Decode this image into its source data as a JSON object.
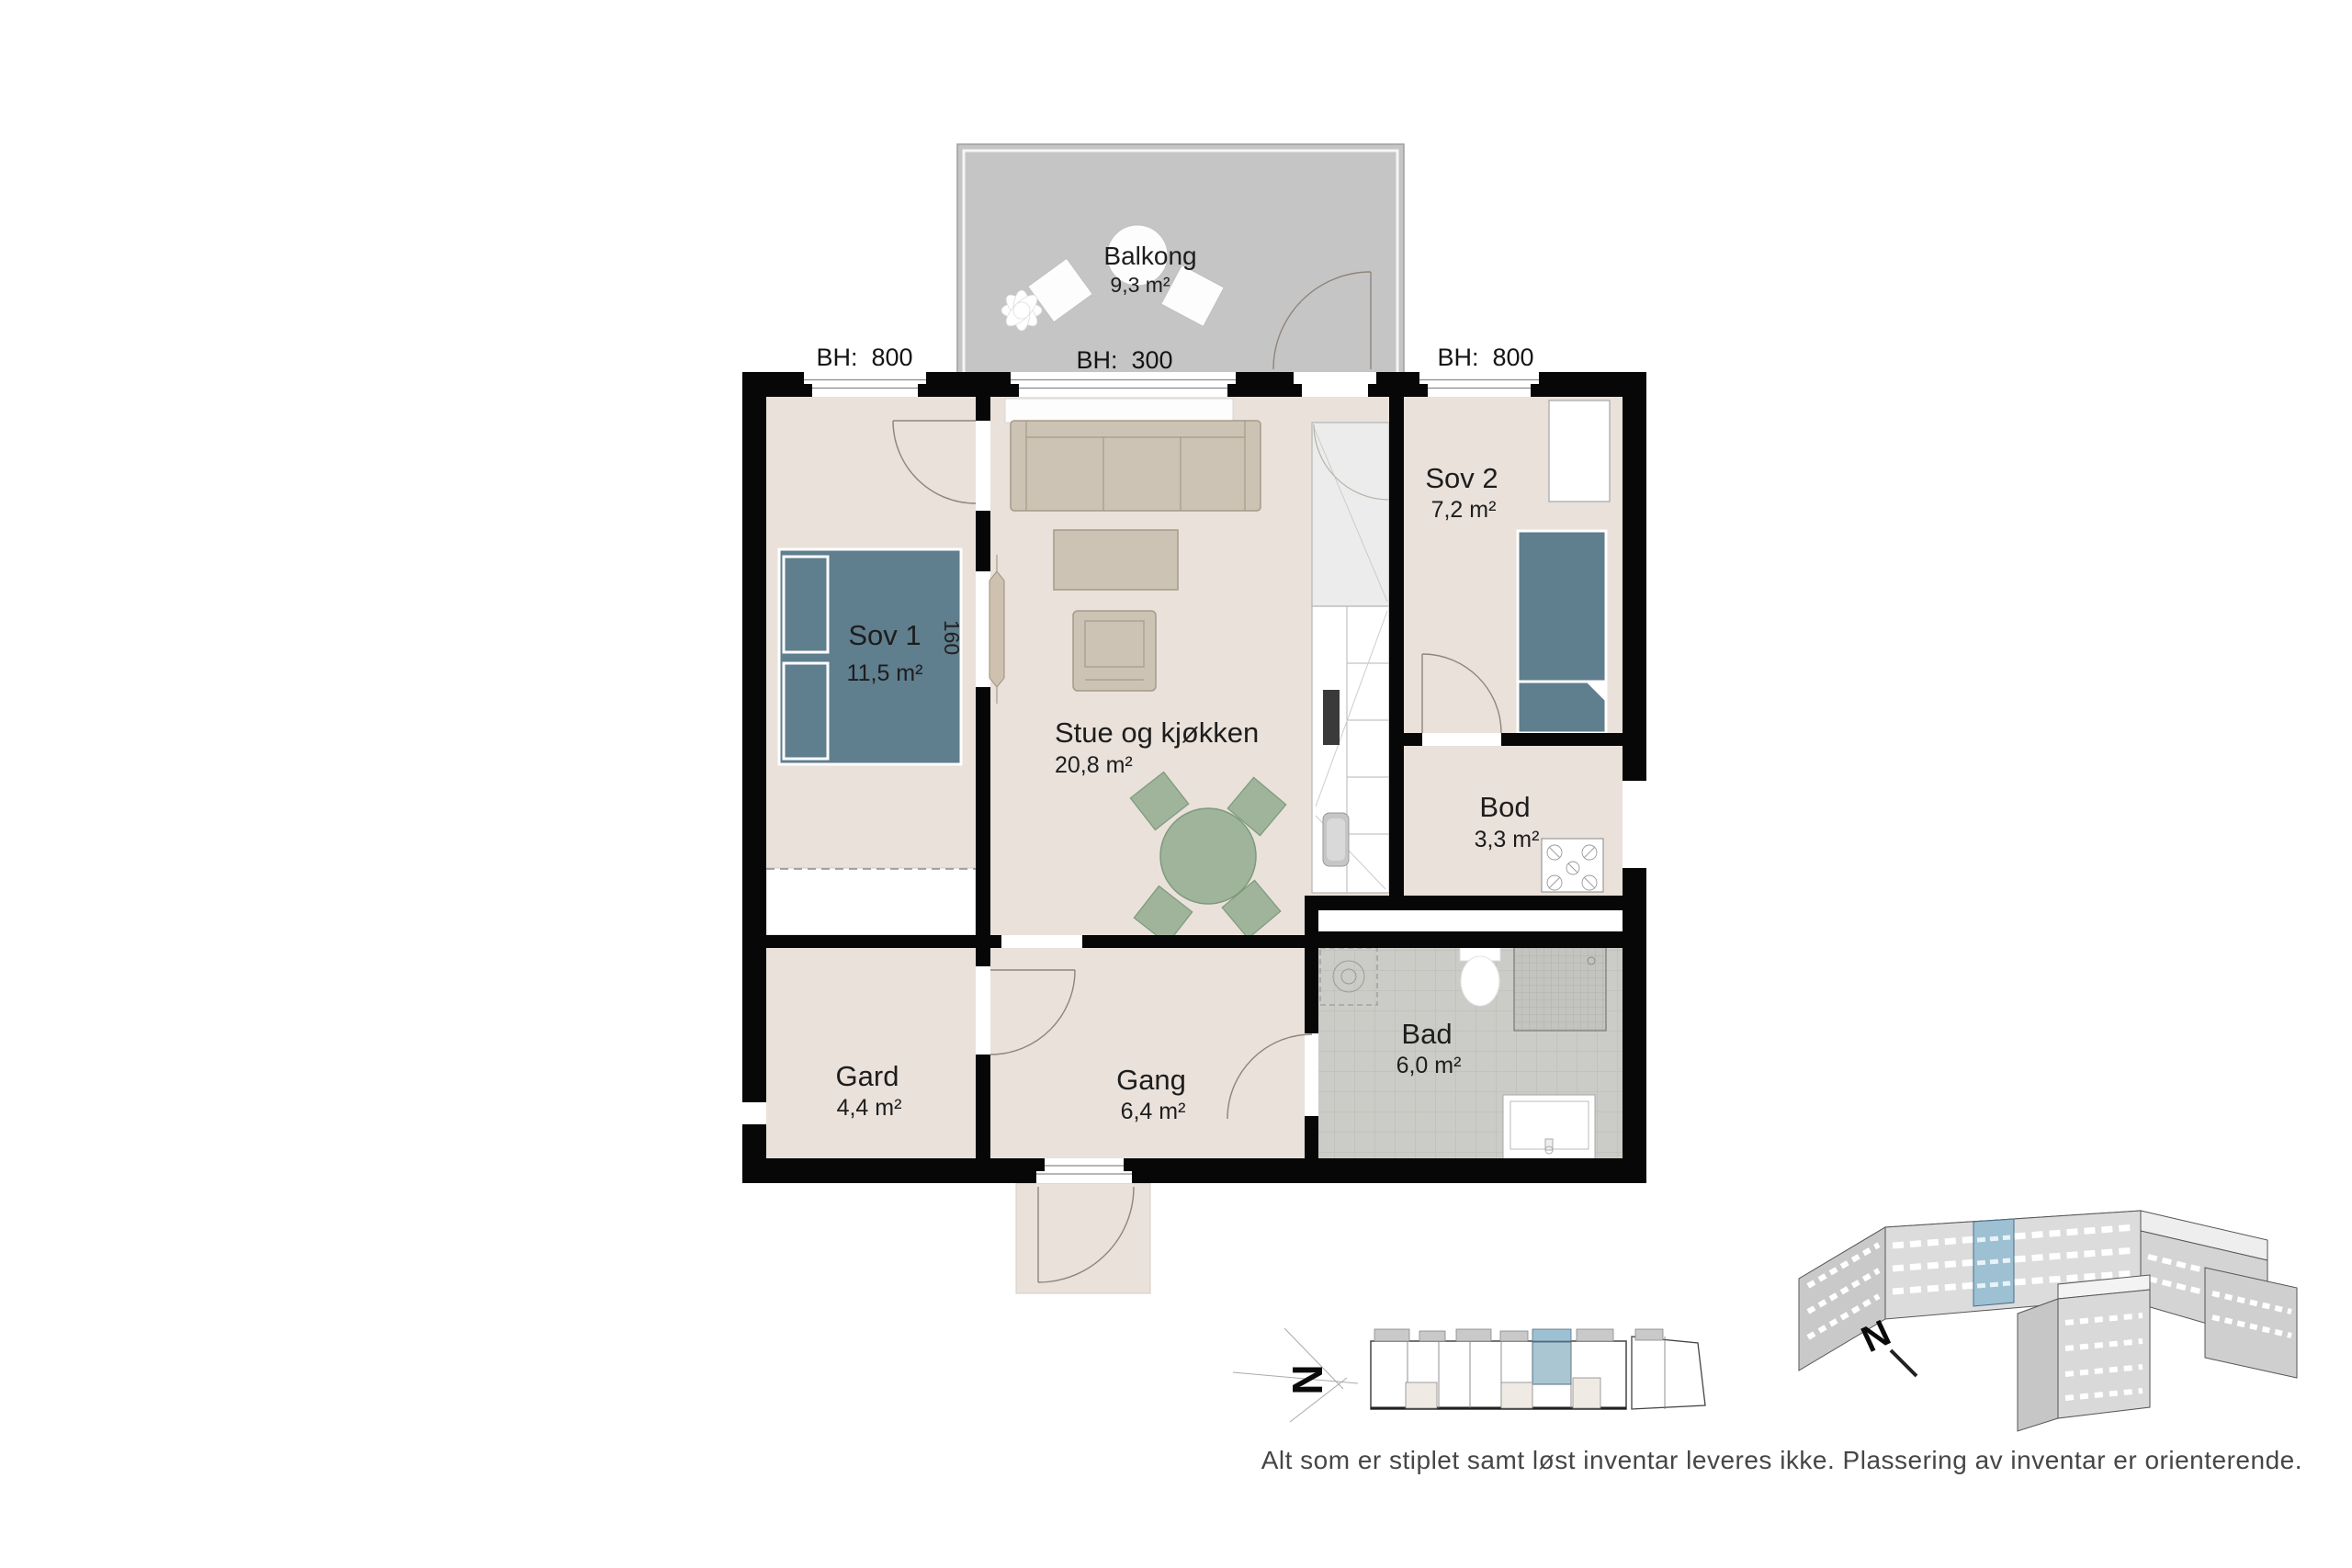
{
  "plan": {
    "rooms": [
      {
        "name": "Sov 1",
        "area": "11,5 m²"
      },
      {
        "name": "Stue og kjøkken",
        "area": "20,8 m²"
      },
      {
        "name": "Sov 2",
        "area": "7,2 m²"
      },
      {
        "name": "Bod",
        "area": "3,3 m²"
      },
      {
        "name": "Bad",
        "area": "6,0 m²"
      },
      {
        "name": "Gang",
        "area": "6,4 m²"
      },
      {
        "name": "Gard",
        "area": "4,4 m²"
      },
      {
        "name": "Balkong",
        "area": "9,3 m²"
      }
    ],
    "bed_width_label": "160",
    "window_heights": [
      {
        "label": "BH:  800"
      },
      {
        "label": "BH:  300"
      },
      {
        "label": "BH:  800"
      }
    ]
  },
  "compass": {
    "label": "N"
  },
  "footer": {
    "disclaimer": "Alt som er stiplet samt løst inventar leveres ikke. Plassering av inventar er orienterende."
  },
  "colors": {
    "wall": "#070707",
    "floor": "#e9e1da",
    "balcony": "#c5c5c5",
    "furniture_blue": "#5f7e8e",
    "furniture_tan": "#ccc3b5",
    "furniture_green": "#9fb49b",
    "bath_tile": "#cbcbc7",
    "highlight_blue": "#9dc0d2"
  }
}
